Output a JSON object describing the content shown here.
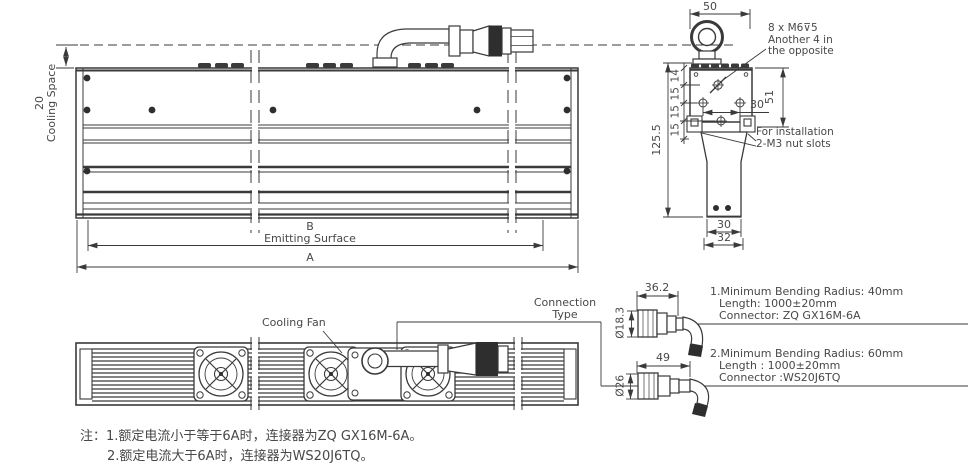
{
  "front_view": {
    "cooling_dim": "20",
    "cooling_label": "Cooling Space",
    "dim_b": "B",
    "emitting_surface": "Emitting Surface",
    "dim_a": "A"
  },
  "side_view": {
    "dim_width_top": "50",
    "thread_note_1": "8 x M6⊽5",
    "thread_note_2": "Another 4 in",
    "thread_note_3": "the opposite",
    "dim_14": "14",
    "dim_15a": "15",
    "dim_15b": "15",
    "dim_15c": "15",
    "dim_total_height": "125.5",
    "dim_hole_spacing": "30",
    "dim_51": "51",
    "install_note_1": "For installation",
    "install_note_2": "2-M3 nut slots",
    "dim_bottom_inner": "30",
    "dim_bottom_outer": "32"
  },
  "bottom_view": {
    "cooling_fan_label": "Cooling Fan",
    "connection_type_1": "Connection",
    "connection_type_2": "Type"
  },
  "connector_options": {
    "option1": {
      "dim_length": "36.2",
      "dim_diameter": "Ø18.3",
      "line1": "1.Minimum Bending Radius: 40mm",
      "line2": "Length: 1000±20mm",
      "line3": "Connector: ZQ GX16M-6A"
    },
    "option2": {
      "dim_length": "49",
      "dim_diameter": "Ø26",
      "line1": "2.Minimum Bending Radius: 60mm",
      "line2": "Length : 1000±20mm",
      "line3": "Connector :WS20J6TQ"
    }
  },
  "notes": {
    "line1": "注：1.额定电流小于等于6A时，连接器为ZQ GX16M-6A。",
    "line2": "2.额定电流大于6A时，连接器为WS20J6TQ。"
  },
  "colors": {
    "line": "#3a3a3a",
    "text": "#48484a",
    "background": "#ffffff"
  }
}
